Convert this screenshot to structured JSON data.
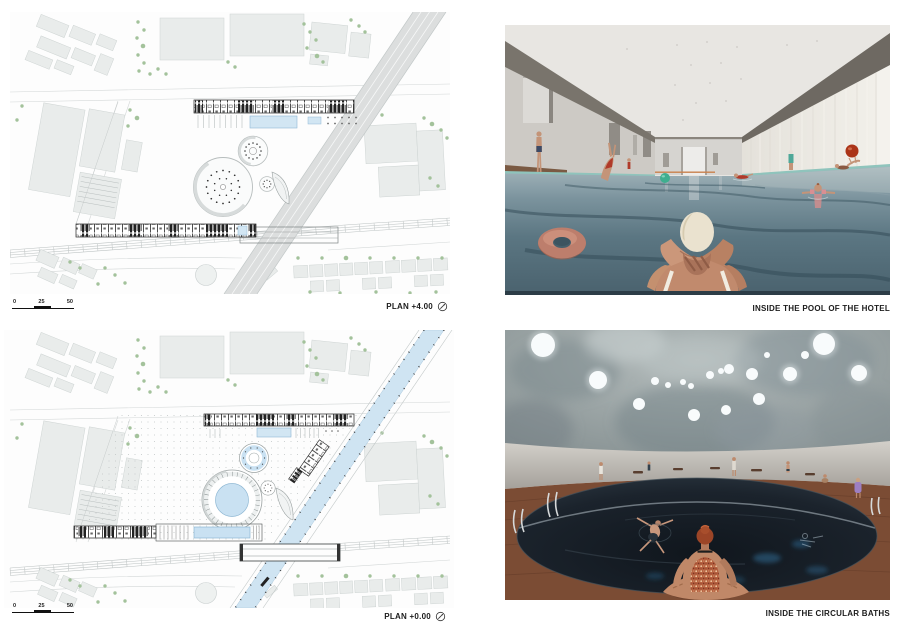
{
  "panels": {
    "plan_top": {
      "caption": "PLAN +4.00",
      "scale_labels": [
        "0",
        "25",
        "50"
      ]
    },
    "render_pool": {
      "caption": "INSIDE THE POOL OF THE HOTEL"
    },
    "plan_bottom": {
      "caption": "PLAN +0.00",
      "scale_labels": [
        "0",
        "25",
        "50"
      ]
    },
    "render_baths": {
      "caption": "INSIDE THE CIRCULAR BATHS"
    }
  },
  "icons": {
    "north_arrow": "north-arrow-compass"
  },
  "colors": {
    "plan_water": "#cfe4f2",
    "tree_green": "#a3c29b",
    "highway_gray": "#dcdede",
    "pool_water_far": "#a4b6bc",
    "pool_water_near": "#4a626e",
    "teal_pool_edge": "#8fc4bc",
    "swim_ring_pink": "#bd7e6c",
    "ball_green": "#3fae8f",
    "ball_red": "#ab3418",
    "beam_gray": "#76716a",
    "dome_gray": "#96a0a2",
    "bath_water": "#161d24",
    "deck_brown": "#7b4c34"
  }
}
